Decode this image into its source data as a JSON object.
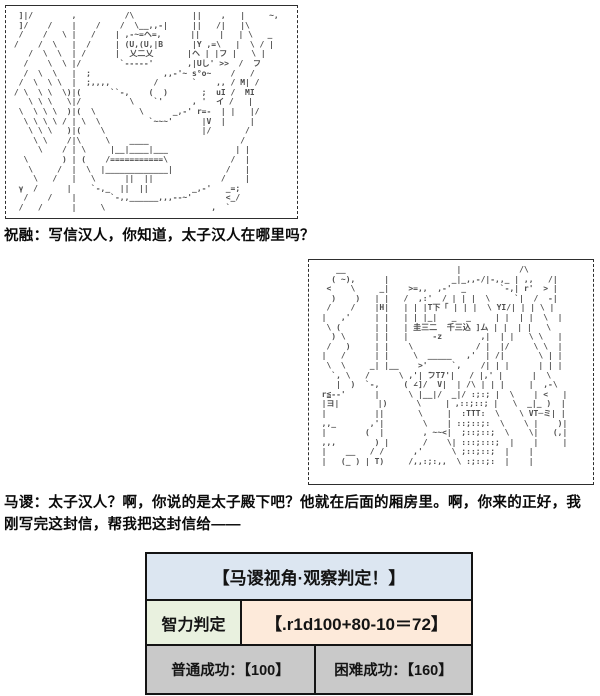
{
  "panels": {
    "aa1": {
      "description": "ascii-art-zhurong-scene",
      "art": "  ]|/        ,          /\\            ||    ,   |     ~,\n  ]/    /    |    /    /  \\__,,-|     ||   /|   |\\\n  /    /   \\ |   /    | ,-~=ヘ=,      ||    |   | \\   _\n /    /  \\   |  /     | (U,(U,|B      |Y ,=\\   |  \\ / |\n    /  \\  \\  | /      |  乂二乂       |ヘ | |フ |   \\ |\n   /    \\  \\ |/        `-----'       ,|Uし' >>  /  フ\n   /  \\  \\   |  ;               ,,-'~ s°o~    /   /\n  /  \\  \\ \\  |  ;,,,,         /       `    ,, / M| /\n / \\  \\ \\  \\)|(      ``-,    (  )       ;  uI /  MI\n    \\ \\ \\   \\|/          \\    `'      , '  イ /   |\n  \\  \\ \\ \\  )|(  \\         \\      _,-' r=-  | |   |/\n   \\ \\ \\ \\ / | \\  \\          `~~~'      |V  |     |\n    \\ \\ \\   )|(    \\                    |/       /\n     \\ \\    /|\\     \\    ____                   /\n      \\    / | \\     |__|____|___              | |\n   \\       ) | (    /===========\\             /  |\n    \\     /  |  \\  |_____________|           /   |\n     \\   /   |   \\      ||  ||              /    |\n  γ  /      |    `-,_  ||  ||         _,-'   _=;\n   /    /    |       `-,,______,,,--~'       <_/\n  /   /      |     \\                      ,  `"
    },
    "aa2": {
      "description": "ascii-art-masu-writing-letter",
      "art": "     __                       |            /\\\n    ( ~),      |             _|_,,-/|-,,_ | ,,   /|\n   <    \\     _|    >=,,  ,-'  _       `-,| r'  > |\n    )    )   | |   /  ,:'  / | | |  \\     `|  /  -|\n   /    /    |H|   | | |T下「 | | |  \\ ΥΙ/| | | \\ |\n  |   ,'     | |   | | |_|   _  _     | |  | |  \\  |\n   \\ (       | |   | 圭三二  千三込 ]ム | |  | |   \\\n    ) \\      | |   |     -z        ,|  | |   \\ \\   |\n   /   )     | |    \\             / |  |/     \\ \\  |\n  |   /      | |     \\  _____   ,'  | /|       \\ | |\n   \\  \\     _| |__    >'     `,    /| | |      | | |\n    `, \\   /      \\ ,'| ̄フT7'|   / |,' |      |  \\\n     |  )  `-,     ( ∠]/  V|  | /\\ | | |     |  ,-\\\n  r≦--'      |      \\ |__|/  _|/ :;:; |  \\    | <   |\n  |ヨ|        |)      \\     | ,::;::; |   \\  _|_ )  |\n  |          ||       \\     |  :TTT:  \\    \\ VT─ミ| |\n  ,,_       ,'|        \\    | ::;::;:  \\    \\ |    )|\n  |        (  |        , ~~<|  ;::;::;  \\    \\|   (,|\n  ,,,        ) |       /    \\| :::;:::;  |    |     |\n  |    __   / /      ,'      \\ ;::;::;  |    |\n  |   (_ ) | T)     /,,:;:,,  \\ :;::;:  |    |"
    }
  },
  "dialogue": {
    "line1": "祝融：写信汉人，你知道，太子汉人在哪里吗？",
    "line2": "马谡：太子汉人？啊，你说的是太子殿下吧？他就在后面的厢房里。啊，你来的正好，我刚写完这封信，帮我把这封信给——"
  },
  "judge_table": {
    "title": "【马谡视角·观察判定！】",
    "skill_label": "智力判定",
    "roll_result": "【.r1d100+80-10＝72】",
    "normal_success": "普通成功：【100】",
    "hard_success": "困难成功：【160】",
    "colors": {
      "header_bg": "#dce6f1",
      "skill_bg": "#e9f1df",
      "roll_bg": "#fdeada",
      "result_bg": "#c9c9c9",
      "border": "#141414"
    }
  }
}
